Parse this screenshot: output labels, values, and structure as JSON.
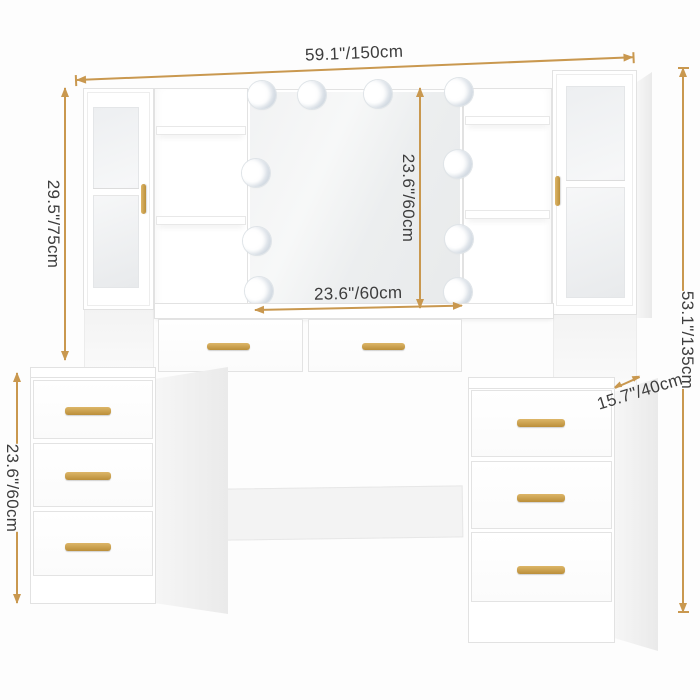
{
  "dimensions": {
    "overall_width": "59.1\"/150cm",
    "hutch_height": "29.5\"/75cm",
    "mirror_height": "23.6\"/60cm",
    "mirror_width": "23.6\"/60cm",
    "overall_height": "53.1\"/135cm",
    "depth": "15.7\"/40cm",
    "pedestal_height": "23.6\"/60cm"
  },
  "style": {
    "dimension_line_color": "#C9984F",
    "dimension_text_color": "#3D3D3D",
    "handle_color": "#C9A24E",
    "furniture_color": "#FFFFFF"
  },
  "furniture": {
    "led_bulb_count": 10,
    "glass_door_cabinets": 2,
    "open_shelf_compartments": 4,
    "center_drawers": 2,
    "left_pedestal_drawers": 3,
    "right_pedestal_drawers": 3
  }
}
